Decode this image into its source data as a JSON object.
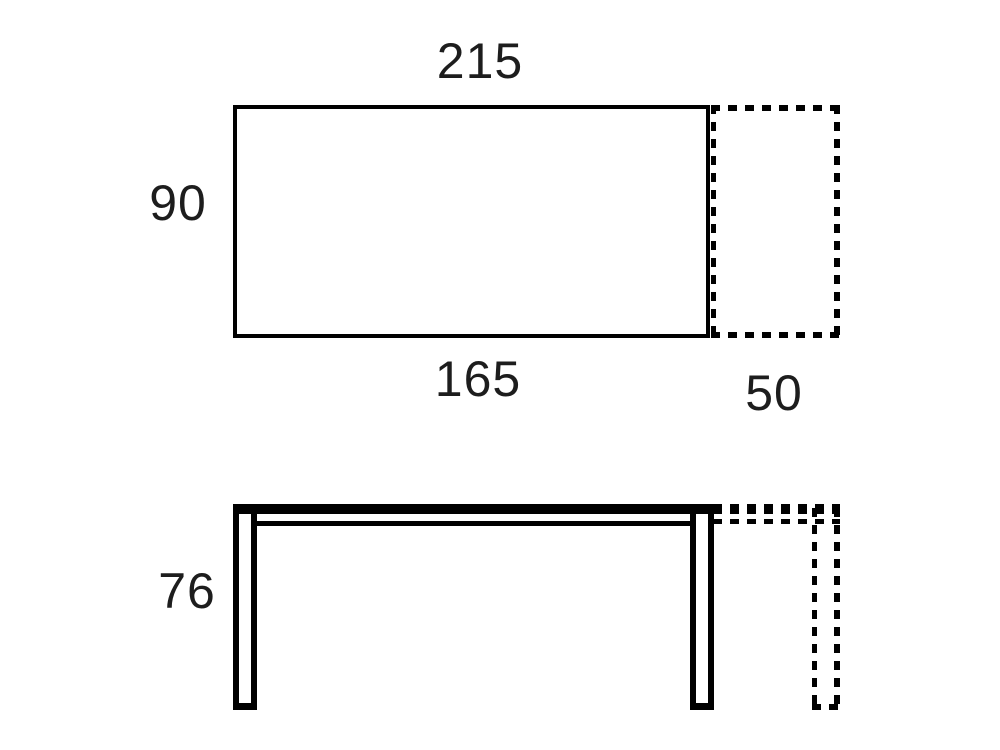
{
  "labels": {
    "total_length": "215",
    "depth": "90",
    "closed_length": "165",
    "extension": "50",
    "height": "76"
  },
  "colors": {
    "line": "#000000",
    "text": "#1d1d1d",
    "background": "#ffffff"
  }
}
